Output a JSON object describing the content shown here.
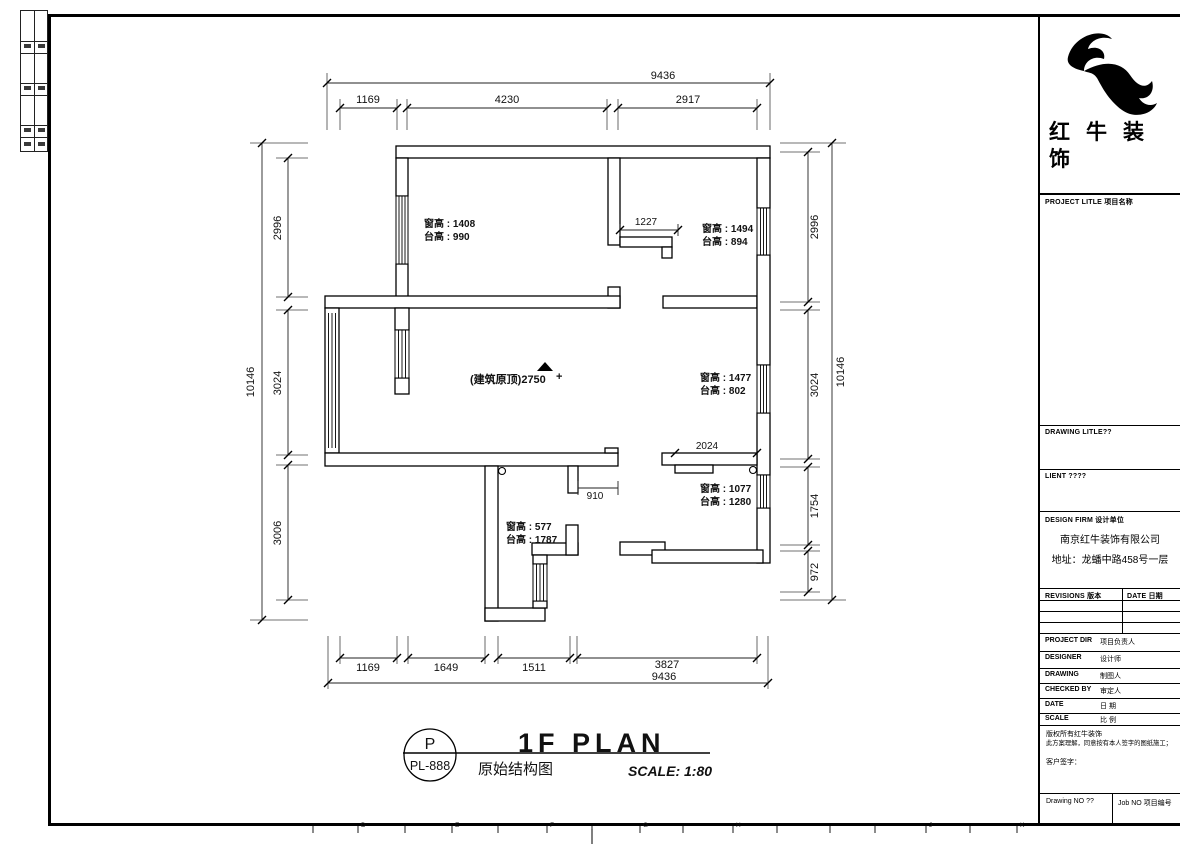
{
  "sheet": {
    "grid_letters": [
      "D",
      "E",
      "F",
      "G",
      "H",
      "J",
      "K"
    ]
  },
  "plan": {
    "ceiling_note": "(建筑原顶)2750",
    "ceiling_plus": "+",
    "dims": {
      "top_overall": "9436",
      "top_segs": [
        "1169",
        "4230",
        "2917"
      ],
      "bottom_segs": [
        "1169",
        "1649",
        "1511",
        "3827"
      ],
      "bottom_overall": "9436",
      "left_overall": "10146",
      "left_segs": [
        "2996",
        "3024",
        "3006"
      ],
      "right_overall": "10146",
      "right_segs": [
        "2996",
        "3024",
        "1754",
        "972"
      ],
      "passage_1227": "1227",
      "opening_2024": "2024",
      "opening_910": "910"
    },
    "windows": [
      {
        "l1": "窗高 : 1408",
        "l2": "台高 : 990"
      },
      {
        "l1": "窗高 : 1494",
        "l2": "台高 : 894"
      },
      {
        "l1": "窗高 : 1477",
        "l2": "台高 : 802"
      },
      {
        "l1": "窗高 : 1077",
        "l2": "台高 : 1280"
      },
      {
        "l1": "窗高 : 577",
        "l2": "台高 : 1787"
      }
    ]
  },
  "titlebar": {
    "bubble_top": "P",
    "bubble_code": "PL-888",
    "main_title": "1F PLAN",
    "sub_title": "原始结构图",
    "scale": "SCALE: 1:80"
  },
  "title_block": {
    "logo_text": "红牛装饰",
    "project_title_label": "PROJECT LITLE 项目名称",
    "drawing_title_label": "DRAWING LITLE??",
    "client_label": "LIENT ????",
    "design_firm_label": "DESIGN FIRM 设计单位",
    "firm_name": "南京红牛装饰有限公司",
    "firm_address": "地址：龙蟠中路458号一层",
    "revisions_label": "REVISIONS 版本",
    "date_label": "DATE 日期",
    "rows": [
      {
        "en": "PROJECT DIR",
        "cn": "项目负责人"
      },
      {
        "en": "DESIGNER",
        "cn": "设计师"
      },
      {
        "en": "DRAWING",
        "cn": "制图人"
      },
      {
        "en": "CHECKED BY",
        "cn": "审定人"
      },
      {
        "en": "DATE",
        "cn": "日 期"
      },
      {
        "en": "SCALE",
        "cn": "比 例"
      }
    ],
    "copyright_line1": "版权所有红牛装饰",
    "copyright_line2": "此方案理解，同意按有本人签字的图纸施工；",
    "copyright_line3": "客户签字：",
    "drawing_no_label": "Drawing NO ??",
    "job_no_label": "Job NO 项目编号"
  }
}
